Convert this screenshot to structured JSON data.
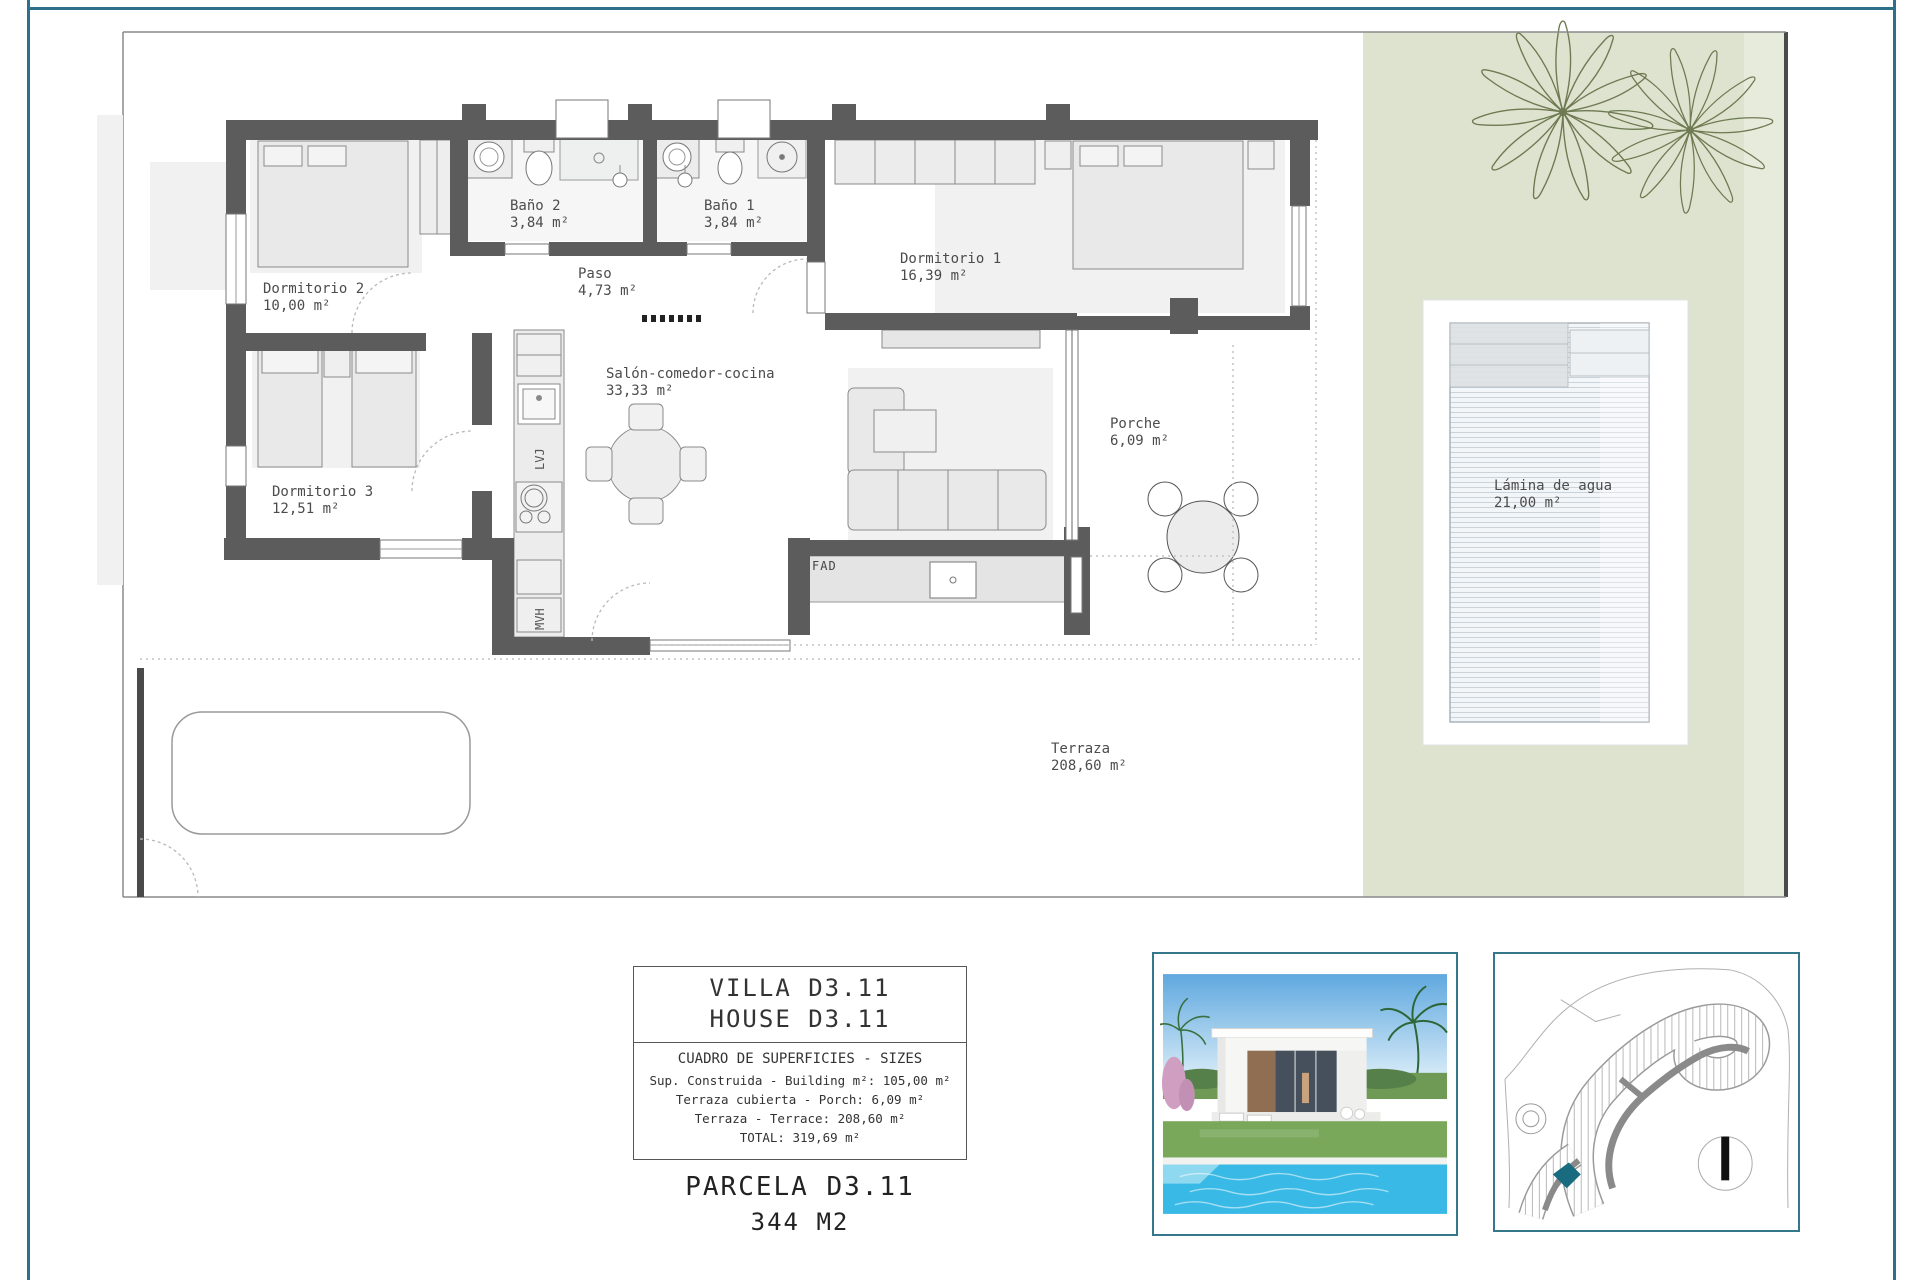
{
  "plan": {
    "rooms": [
      {
        "name": "Dormitorio 2",
        "area": "10,00 m²"
      },
      {
        "name": "Baño 2",
        "area": "3,84 m²"
      },
      {
        "name": "Baño 1",
        "area": "3,84 m²"
      },
      {
        "name": "Paso",
        "area": "4,73 m²"
      },
      {
        "name": "Dormitorio 1",
        "area": "16,39 m²"
      },
      {
        "name": "Dormitorio 3",
        "area": "12,51 m²"
      },
      {
        "name": "Salón-comedor-cocina",
        "area": "33,33 m²"
      },
      {
        "name": "Porche",
        "area": "6,09 m²"
      },
      {
        "name": "Terraza",
        "area": "208,60 m²"
      },
      {
        "name": "Lámina de agua",
        "area": "21,00 m²"
      }
    ],
    "appliances": {
      "bbq": "FAD",
      "dishwasher": "LVJ",
      "washer": "MVH"
    }
  },
  "info_box": {
    "title_line1": "VILLA D3.11",
    "title_line2": "HOUSE D3.11",
    "table_header": "CUADRO DE SUPERFICIES  - SIZES",
    "rows": [
      "Sup. Construida  - Building m²: 105,00 m²",
      "Terraza cubierta  - Porch: 6,09 m²",
      "Terraza - Terrace: 208,60 m²",
      "TOTAL:  319,69 m²"
    ],
    "parcel_title": "PARCELA D3.11",
    "parcel_area": "344 M2"
  },
  "colors": {
    "frame_teal": "#2e708a",
    "garden_green": "#dde3cf",
    "wall_gray": "#5c5c5c",
    "thumb_border": "#35788c",
    "site_plot_highlight": "#196b80"
  }
}
